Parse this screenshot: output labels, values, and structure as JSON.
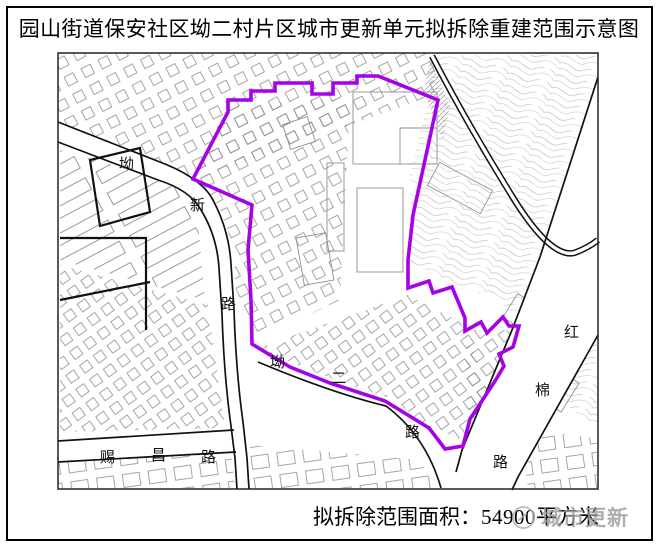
{
  "page": {
    "title": "园山街道保安社区坳二村片区城市更新单元拟拆除重建范围示意图",
    "caption_label": "拟拆除范围面积：",
    "caption_value": "54900",
    "caption_unit": "平方米",
    "watermark_text": "城市更新"
  },
  "map": {
    "road_labels": [
      {
        "name": "aoxin-road-char-ao",
        "text": "坳"
      },
      {
        "name": "aoxin-road-char-xin",
        "text": "新"
      },
      {
        "name": "aoxin-road-char-lu",
        "text": "路"
      },
      {
        "name": "aoer-road-char-ao",
        "text": "坳"
      },
      {
        "name": "aoer-road-char-er",
        "text": "二"
      },
      {
        "name": "aoer-road-char-lu",
        "text": "路"
      },
      {
        "name": "cichang-road-char-ci",
        "text": "赐"
      },
      {
        "name": "cichang-road-char-chang",
        "text": "昌"
      },
      {
        "name": "cichang-road-char-lu",
        "text": "路"
      },
      {
        "name": "hongmian-road-char-hong",
        "text": "红"
      },
      {
        "name": "hongmian-road-char-mian",
        "text": "棉"
      },
      {
        "name": "hongmian-road-char-lu",
        "text": "路"
      }
    ]
  },
  "colors": {
    "boundary_purple": "#A602E8",
    "road_black": "#111111",
    "building_gray": "#8f8f8f",
    "contour_gray": "#bdbdbd",
    "watermark_gray": "#9a9a9a"
  }
}
